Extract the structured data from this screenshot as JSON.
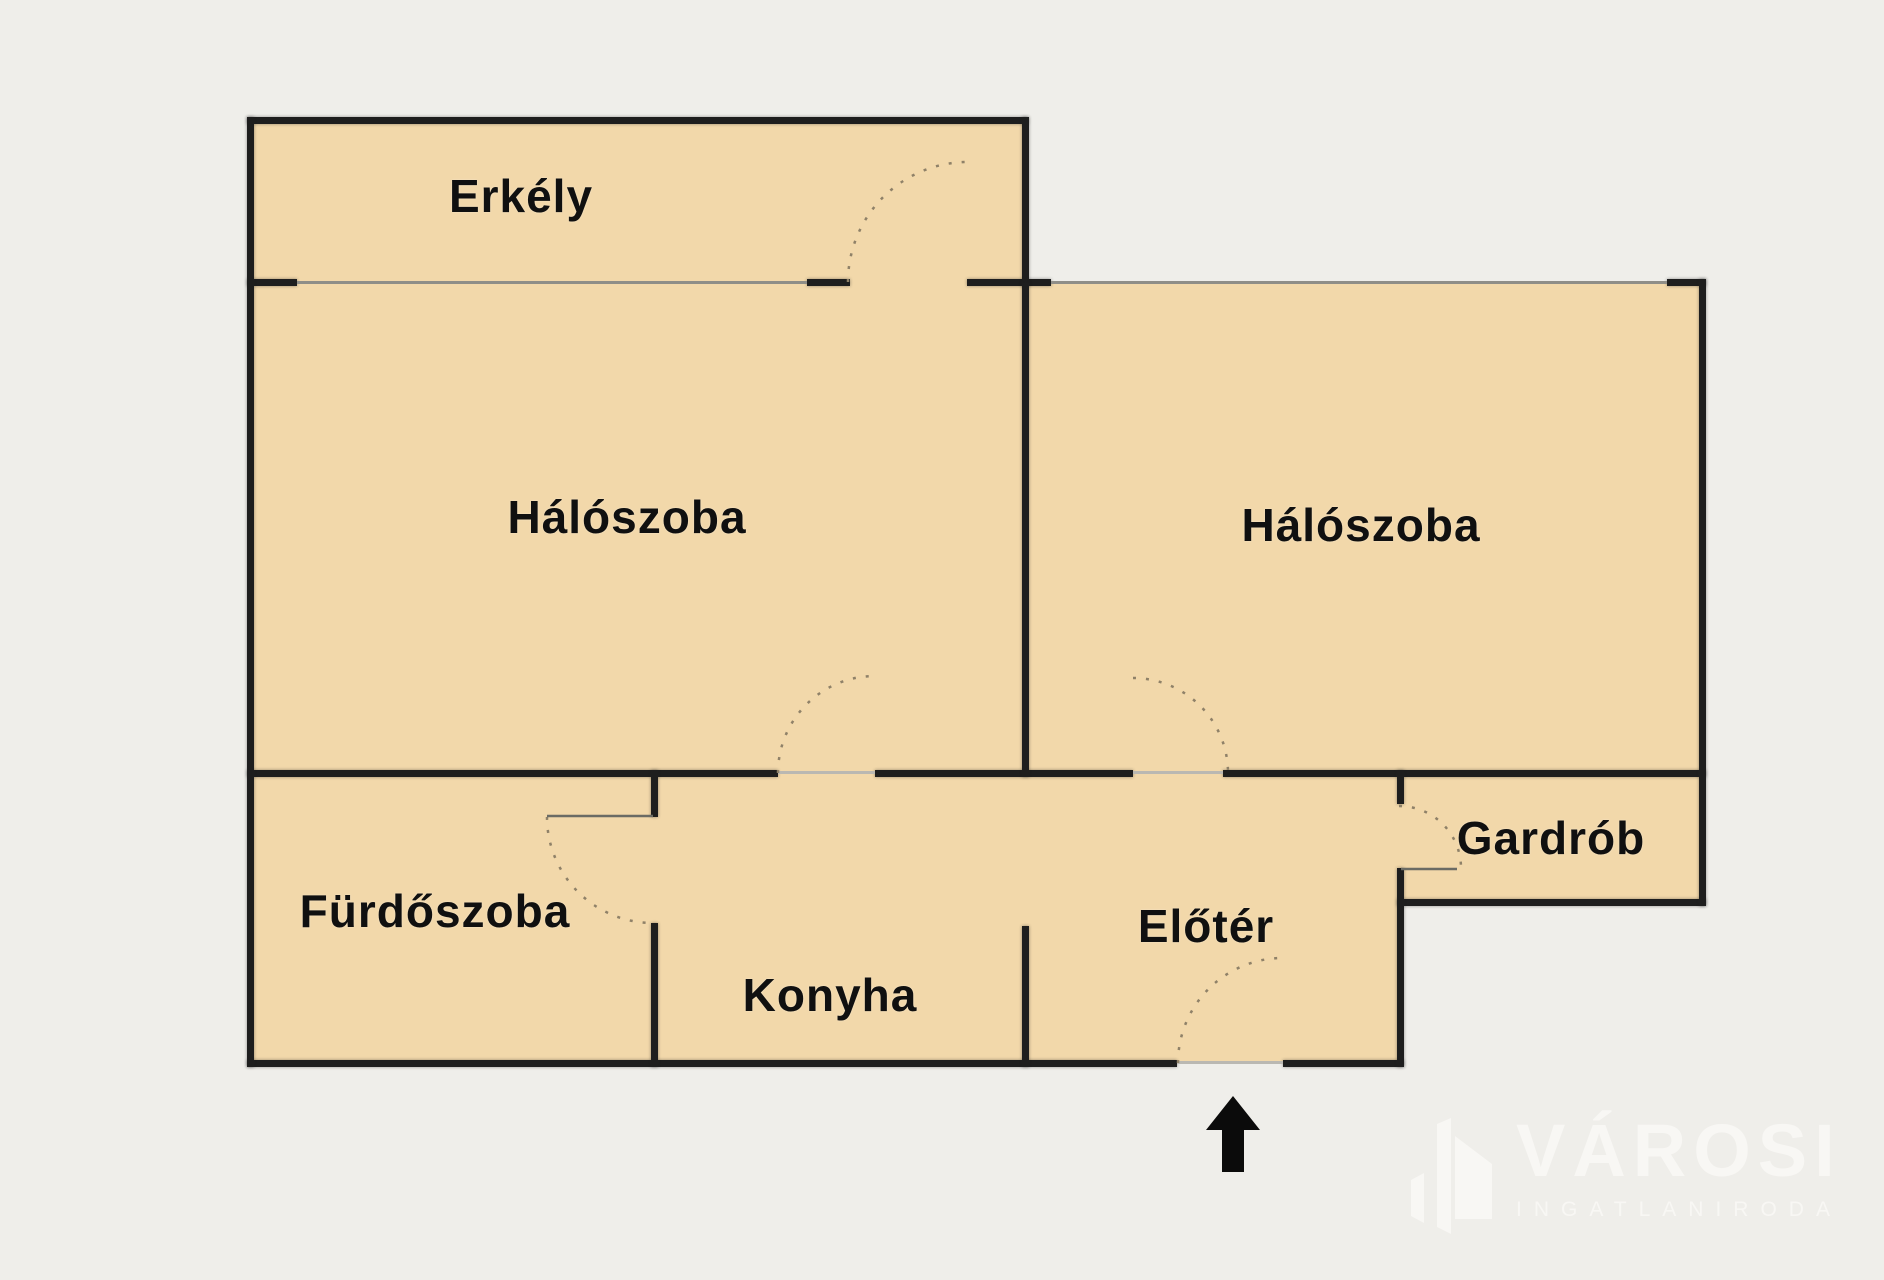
{
  "page": {
    "background": "#efeeea"
  },
  "plan": {
    "room_fill": "#f2d8aa",
    "wall_color": "#1e1e1e",
    "window_line_color": "#8f8e88",
    "threshold_color": "#bab8b2",
    "door_arc_color": "#8f8168",
    "door_leaf_color": "#6b6b64",
    "label_color": "#101010",
    "rooms": [
      {
        "name": "erkely",
        "label": "Erkély",
        "x": 250,
        "y": 121,
        "w": 775,
        "h": 162,
        "label_cx": 521,
        "label_cy": 196
      },
      {
        "name": "haloszoba-bal",
        "label": "Hálószoba",
        "x": 250,
        "y": 283,
        "w": 775,
        "h": 490,
        "label_cx": 627,
        "label_cy": 517
      },
      {
        "name": "haloszoba-jobb",
        "label": "Hálószoba",
        "x": 1025,
        "y": 283,
        "w": 678,
        "h": 490,
        "label_cx": 1361,
        "label_cy": 525
      },
      {
        "name": "furdoszoba",
        "label": "Fürdőszoba",
        "x": 250,
        "y": 773,
        "w": 405,
        "h": 290,
        "label_cx": 435,
        "label_cy": 911
      },
      {
        "name": "konyha",
        "label": "Konyha",
        "x": 655,
        "y": 773,
        "w": 370,
        "h": 290,
        "label_cx": 830,
        "label_cy": 995
      },
      {
        "name": "eloter",
        "label": "Előtér",
        "x": 1025,
        "y": 773,
        "w": 375,
        "h": 290,
        "label_cx": 1206,
        "label_cy": 926
      },
      {
        "name": "gardrob",
        "label": "Gardrób",
        "x": 1400,
        "y": 773,
        "w": 303,
        "h": 129,
        "label_cx": 1551,
        "label_cy": 838
      }
    ],
    "walls": [
      {
        "x": 247,
        "y": 117,
        "w": 781,
        "h": 7
      },
      {
        "x": 247,
        "y": 279,
        "w": 50,
        "h": 7
      },
      {
        "x": 807,
        "y": 279,
        "w": 43,
        "h": 7
      },
      {
        "x": 967,
        "y": 279,
        "w": 84,
        "h": 7
      },
      {
        "x": 1667,
        "y": 279,
        "w": 39,
        "h": 7
      },
      {
        "x": 247,
        "y": 770,
        "w": 531,
        "h": 7
      },
      {
        "x": 875,
        "y": 770,
        "w": 258,
        "h": 7
      },
      {
        "x": 1223,
        "y": 770,
        "w": 483,
        "h": 7
      },
      {
        "x": 1397,
        "y": 899,
        "w": 309,
        "h": 7
      },
      {
        "x": 247,
        "y": 1060,
        "w": 930,
        "h": 7
      },
      {
        "x": 1283,
        "y": 1060,
        "w": 121,
        "h": 7
      },
      {
        "x": 247,
        "y": 117,
        "w": 7,
        "h": 950
      },
      {
        "x": 1022,
        "y": 117,
        "w": 7,
        "h": 169
      },
      {
        "x": 1022,
        "y": 283,
        "w": 7,
        "h": 494
      },
      {
        "x": 1699,
        "y": 279,
        "w": 7,
        "h": 627
      },
      {
        "x": 651,
        "y": 770,
        "w": 7,
        "h": 47
      },
      {
        "x": 651,
        "y": 923,
        "w": 7,
        "h": 144
      },
      {
        "x": 1022,
        "y": 926,
        "w": 7,
        "h": 141
      },
      {
        "x": 1397,
        "y": 770,
        "w": 7,
        "h": 34
      },
      {
        "x": 1397,
        "y": 868,
        "w": 7,
        "h": 199
      }
    ],
    "windows": [
      {
        "x": 297,
        "y": 281,
        "w": 510,
        "h": 3
      },
      {
        "x": 1051,
        "y": 281,
        "w": 616,
        "h": 3
      }
    ],
    "thresholds": [
      {
        "x": 778,
        "y": 771,
        "w": 97,
        "h": 3
      },
      {
        "x": 1133,
        "y": 771,
        "w": 90,
        "h": 3
      },
      {
        "x": 1177,
        "y": 1061,
        "w": 106,
        "h": 3
      }
    ],
    "door_arcs": [
      {
        "door": "erkely-door",
        "d": "M 848 282 A 120 120 0 0 1 968 162"
      },
      {
        "door": "haloszoba-bal-door",
        "d": "M 778 773 A 97 97 0 0 1 875 676"
      },
      {
        "door": "haloszoba-jobb-door",
        "d": "M 1133 678 A 95 95 0 0 1 1228 773"
      },
      {
        "door": "furdoszoba-door",
        "d": "M 547 817 A 106 106 0 0 0 653 923"
      },
      {
        "door": "gardrob-door",
        "d": "M 1399 806 A 62 62 0 0 1 1461 868"
      },
      {
        "door": "bejarat-door",
        "d": "M 1178 1063 A 105 105 0 0 1 1283 958"
      }
    ],
    "door_leaves": [
      {
        "x1": 547,
        "y1": 816,
        "x2": 653,
        "y2": 816
      },
      {
        "x1": 1401,
        "y1": 869,
        "x2": 1457,
        "y2": 869
      }
    ],
    "entrance_arrow": {
      "points": "1233,1096 1260,1130 1244,1130 1244,1172 1222,1172 1222,1130 1206,1130",
      "color": "#0b0b0b"
    }
  },
  "logo": {
    "name": "VÁROSI",
    "subtitle": "INGATLANIRODA",
    "color": "#f8f7f4"
  }
}
